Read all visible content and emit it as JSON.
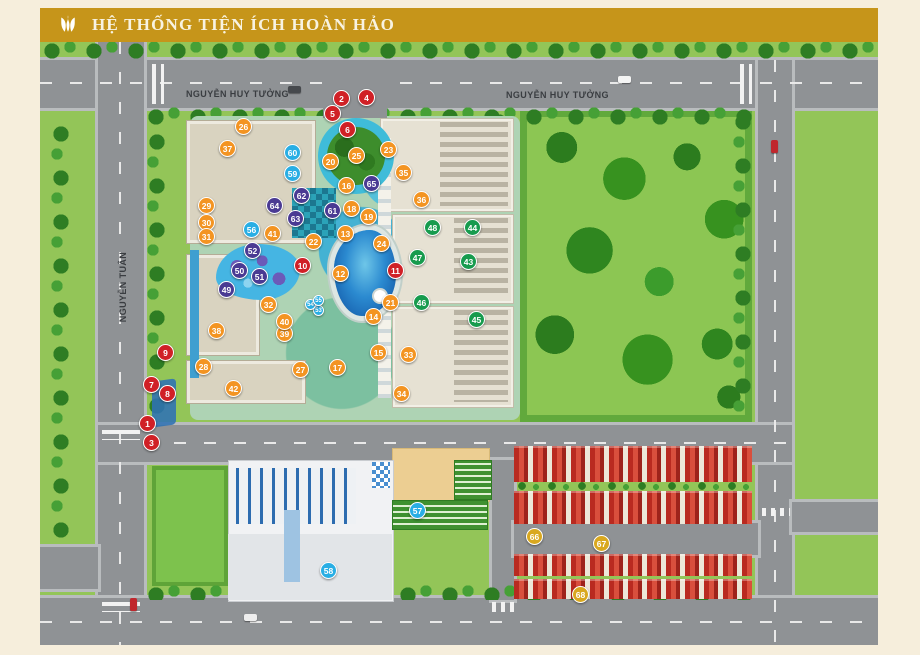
{
  "header": {
    "title": "HỆ THỐNG TIỆN ÍCH HOÀN HẢO",
    "background": "#c6951a",
    "text_color": "#f8f3e1",
    "logo": "tulip-logo"
  },
  "map": {
    "streets": [
      {
        "name": "NGUYỄN HUY TƯỞNG",
        "orientation": "horizontal"
      },
      {
        "name": "NGUYỄN HUY TƯỞNG",
        "orientation": "horizontal"
      },
      {
        "name": "NGUYỄN TUÂN",
        "orientation": "vertical"
      }
    ],
    "marker_colors": {
      "red": "#d02026",
      "orange": "#f39422",
      "green": "#179b4e",
      "purple": "#4a3a93",
      "cyan": "#29aee4",
      "gold": "#d9a81f"
    },
    "markers": [
      {
        "n": 1,
        "x": 108,
        "y": 382,
        "c": "red"
      },
      {
        "n": 2,
        "x": 302,
        "y": 57,
        "c": "red"
      },
      {
        "n": 3,
        "x": 112,
        "y": 401,
        "c": "red"
      },
      {
        "n": 4,
        "x": 327,
        "y": 56,
        "c": "red"
      },
      {
        "n": 5,
        "x": 293,
        "y": 72,
        "c": "red"
      },
      {
        "n": 6,
        "x": 308,
        "y": 88,
        "c": "red"
      },
      {
        "n": 7,
        "x": 112,
        "y": 343,
        "c": "red"
      },
      {
        "n": 8,
        "x": 128,
        "y": 352,
        "c": "red"
      },
      {
        "n": 9,
        "x": 126,
        "y": 311,
        "c": "red"
      },
      {
        "n": 10,
        "x": 263,
        "y": 224,
        "c": "red"
      },
      {
        "n": 11,
        "x": 356,
        "y": 229,
        "c": "red"
      },
      {
        "n": 12,
        "x": 301,
        "y": 232,
        "c": "orange"
      },
      {
        "n": 13,
        "x": 306,
        "y": 192,
        "c": "orange"
      },
      {
        "n": 14,
        "x": 334,
        "y": 275,
        "c": "orange"
      },
      {
        "n": 15,
        "x": 339,
        "y": 311,
        "c": "orange"
      },
      {
        "n": 16,
        "x": 307,
        "y": 144,
        "c": "orange"
      },
      {
        "n": 17,
        "x": 298,
        "y": 326,
        "c": "orange"
      },
      {
        "n": 18,
        "x": 312,
        "y": 167,
        "c": "orange"
      },
      {
        "n": 19,
        "x": 329,
        "y": 175,
        "c": "orange"
      },
      {
        "n": 20,
        "x": 291,
        "y": 120,
        "c": "orange"
      },
      {
        "n": 21,
        "x": 351,
        "y": 261,
        "c": "orange"
      },
      {
        "n": 22,
        "x": 274,
        "y": 200,
        "c": "orange"
      },
      {
        "n": 23,
        "x": 349,
        "y": 108,
        "c": "orange"
      },
      {
        "n": 24,
        "x": 342,
        "y": 202,
        "c": "orange"
      },
      {
        "n": 25,
        "x": 317,
        "y": 114,
        "c": "orange"
      },
      {
        "n": 26,
        "x": 204,
        "y": 85,
        "c": "orange"
      },
      {
        "n": 27,
        "x": 261,
        "y": 328,
        "c": "orange"
      },
      {
        "n": 28,
        "x": 164,
        "y": 325,
        "c": "orange"
      },
      {
        "n": 29,
        "x": 167,
        "y": 164,
        "c": "orange"
      },
      {
        "n": 30,
        "x": 167,
        "y": 181,
        "c": "orange"
      },
      {
        "n": 31,
        "x": 167,
        "y": 195,
        "c": "orange"
      },
      {
        "n": 32,
        "x": 229,
        "y": 263,
        "c": "orange"
      },
      {
        "n": 33,
        "x": 369,
        "y": 313,
        "c": "orange"
      },
      {
        "n": 34,
        "x": 362,
        "y": 352,
        "c": "orange"
      },
      {
        "n": 35,
        "x": 364,
        "y": 131,
        "c": "orange"
      },
      {
        "n": 36,
        "x": 382,
        "y": 158,
        "c": "orange"
      },
      {
        "n": 37,
        "x": 188,
        "y": 107,
        "c": "orange"
      },
      {
        "n": 38,
        "x": 177,
        "y": 289,
        "c": "orange"
      },
      {
        "n": 39,
        "x": 245,
        "y": 292,
        "c": "orange"
      },
      {
        "n": 40,
        "x": 245,
        "y": 280,
        "c": "orange"
      },
      {
        "n": 41,
        "x": 233,
        "y": 192,
        "c": "orange"
      },
      {
        "n": 42,
        "x": 194,
        "y": 347,
        "c": "orange"
      },
      {
        "n": 43,
        "x": 429,
        "y": 220,
        "c": "green"
      },
      {
        "n": 44,
        "x": 433,
        "y": 186,
        "c": "green"
      },
      {
        "n": 45,
        "x": 437,
        "y": 278,
        "c": "green"
      },
      {
        "n": 46,
        "x": 382,
        "y": 261,
        "c": "green"
      },
      {
        "n": 47,
        "x": 378,
        "y": 216,
        "c": "green"
      },
      {
        "n": 48,
        "x": 393,
        "y": 186,
        "c": "green"
      },
      {
        "n": 49,
        "x": 187,
        "y": 248,
        "c": "purple"
      },
      {
        "n": 50,
        "x": 200,
        "y": 229,
        "c": "purple"
      },
      {
        "n": 51,
        "x": 220,
        "y": 235,
        "c": "purple"
      },
      {
        "n": 52,
        "x": 213,
        "y": 209,
        "c": "purple"
      },
      {
        "n": 53,
        "x": 279,
        "y": 269,
        "c": "cyan",
        "small": true
      },
      {
        "n": 54,
        "x": 271,
        "y": 263,
        "c": "cyan",
        "small": true
      },
      {
        "n": 55,
        "x": 279,
        "y": 259,
        "c": "cyan",
        "small": true
      },
      {
        "n": 56,
        "x": 212,
        "y": 188,
        "c": "cyan"
      },
      {
        "n": 57,
        "x": 378,
        "y": 469,
        "c": "cyan"
      },
      {
        "n": 58,
        "x": 289,
        "y": 529,
        "c": "cyan"
      },
      {
        "n": 59,
        "x": 253,
        "y": 132,
        "c": "cyan"
      },
      {
        "n": 60,
        "x": 253,
        "y": 111,
        "c": "cyan"
      },
      {
        "n": 61,
        "x": 293,
        "y": 169,
        "c": "purple"
      },
      {
        "n": 62,
        "x": 262,
        "y": 154,
        "c": "purple"
      },
      {
        "n": 63,
        "x": 256,
        "y": 177,
        "c": "purple"
      },
      {
        "n": 64,
        "x": 235,
        "y": 164,
        "c": "purple"
      },
      {
        "n": 65,
        "x": 332,
        "y": 142,
        "c": "purple"
      },
      {
        "n": 66,
        "x": 495,
        "y": 495,
        "c": "gold"
      },
      {
        "n": 67,
        "x": 562,
        "y": 502,
        "c": "gold"
      },
      {
        "n": 68,
        "x": 541,
        "y": 553,
        "c": "gold"
      }
    ]
  }
}
